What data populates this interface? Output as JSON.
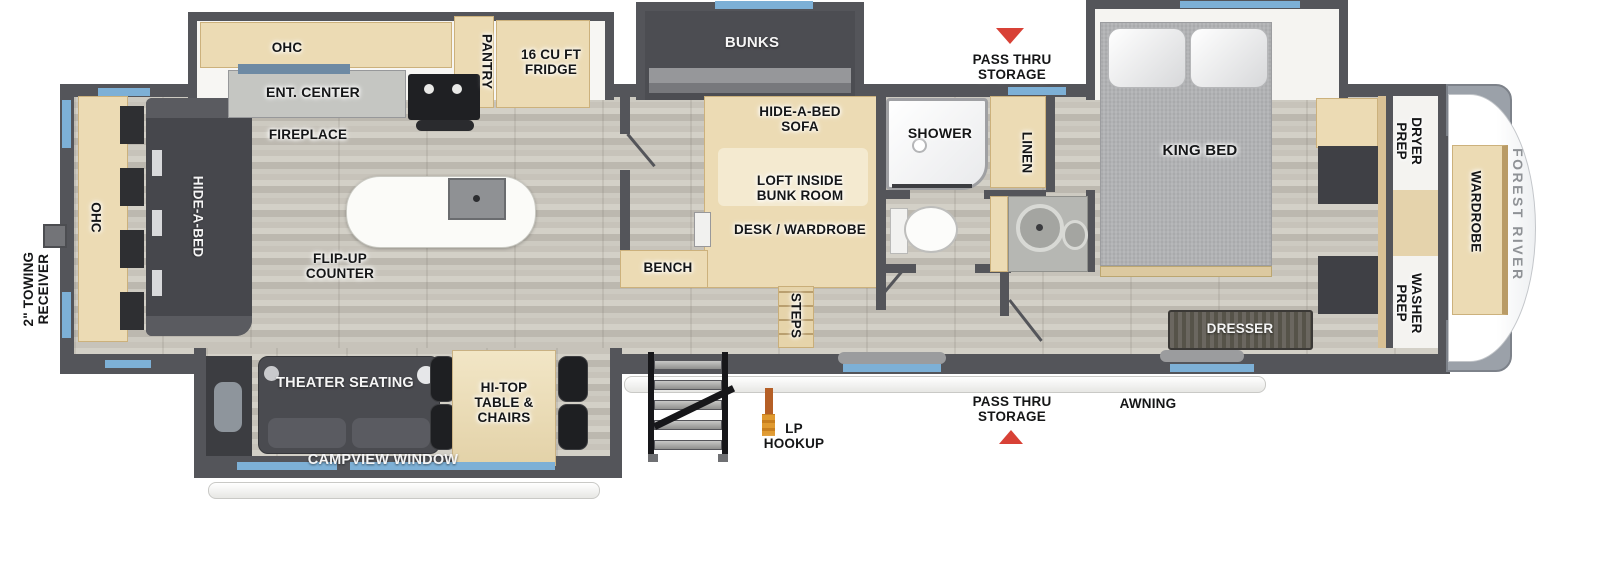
{
  "labels": {
    "towing_receiver": "2\" TOWING\nRECEIVER",
    "rear_ohc": "OHC",
    "rear_hide_a_bed": "HIDE-A-BED",
    "kitchen_ohc": "OHC",
    "ent_center": "ENT. CENTER",
    "pantry": "PANTRY",
    "fridge": "16 CU FT\nFRIDGE",
    "fireplace": "FIREPLACE",
    "flip_up_counter": "FLIP-UP\nCOUNTER",
    "bunks": "BUNKS",
    "pass_thru_top": "PASS THRU\nSTORAGE",
    "hide_a_bed_sofa": "HIDE-A-BED\nSOFA",
    "loft": "LOFT INSIDE\nBUNK ROOM",
    "desk_wardrobe": "DESK / WARDROBE",
    "bench": "BENCH",
    "steps": "STEPS",
    "shower": "SHOWER",
    "linen": "LINEN",
    "king_bed": "KING BED",
    "dresser": "DRESSER",
    "dryer_prep": "DRYER\nPREP",
    "washer_prep": "WASHER\nPREP",
    "wardrobe": "WARDROBE",
    "brand": "FOREST RIVER",
    "theater_seating": "THEATER SEATING",
    "hi_top": "HI-TOP\nTABLE &\nCHAIRS",
    "campview_window": "CAMPVIEW WINDOW",
    "lp_hookup": "LP\nHOOKUP",
    "pass_thru_bottom": "PASS THRU\nSTORAGE",
    "awning": "AWNING"
  },
  "colors": {
    "wall": "#54555a",
    "cabinet_tan": "#ecdbb4",
    "furniture_dark": "#46474c",
    "window_blue": "#7db0d6",
    "arrow_red": "#d84136",
    "mattress_gray": "#b2b3b5",
    "floor_wood": "#c9c5bc",
    "brand_text": "#8f9296"
  }
}
